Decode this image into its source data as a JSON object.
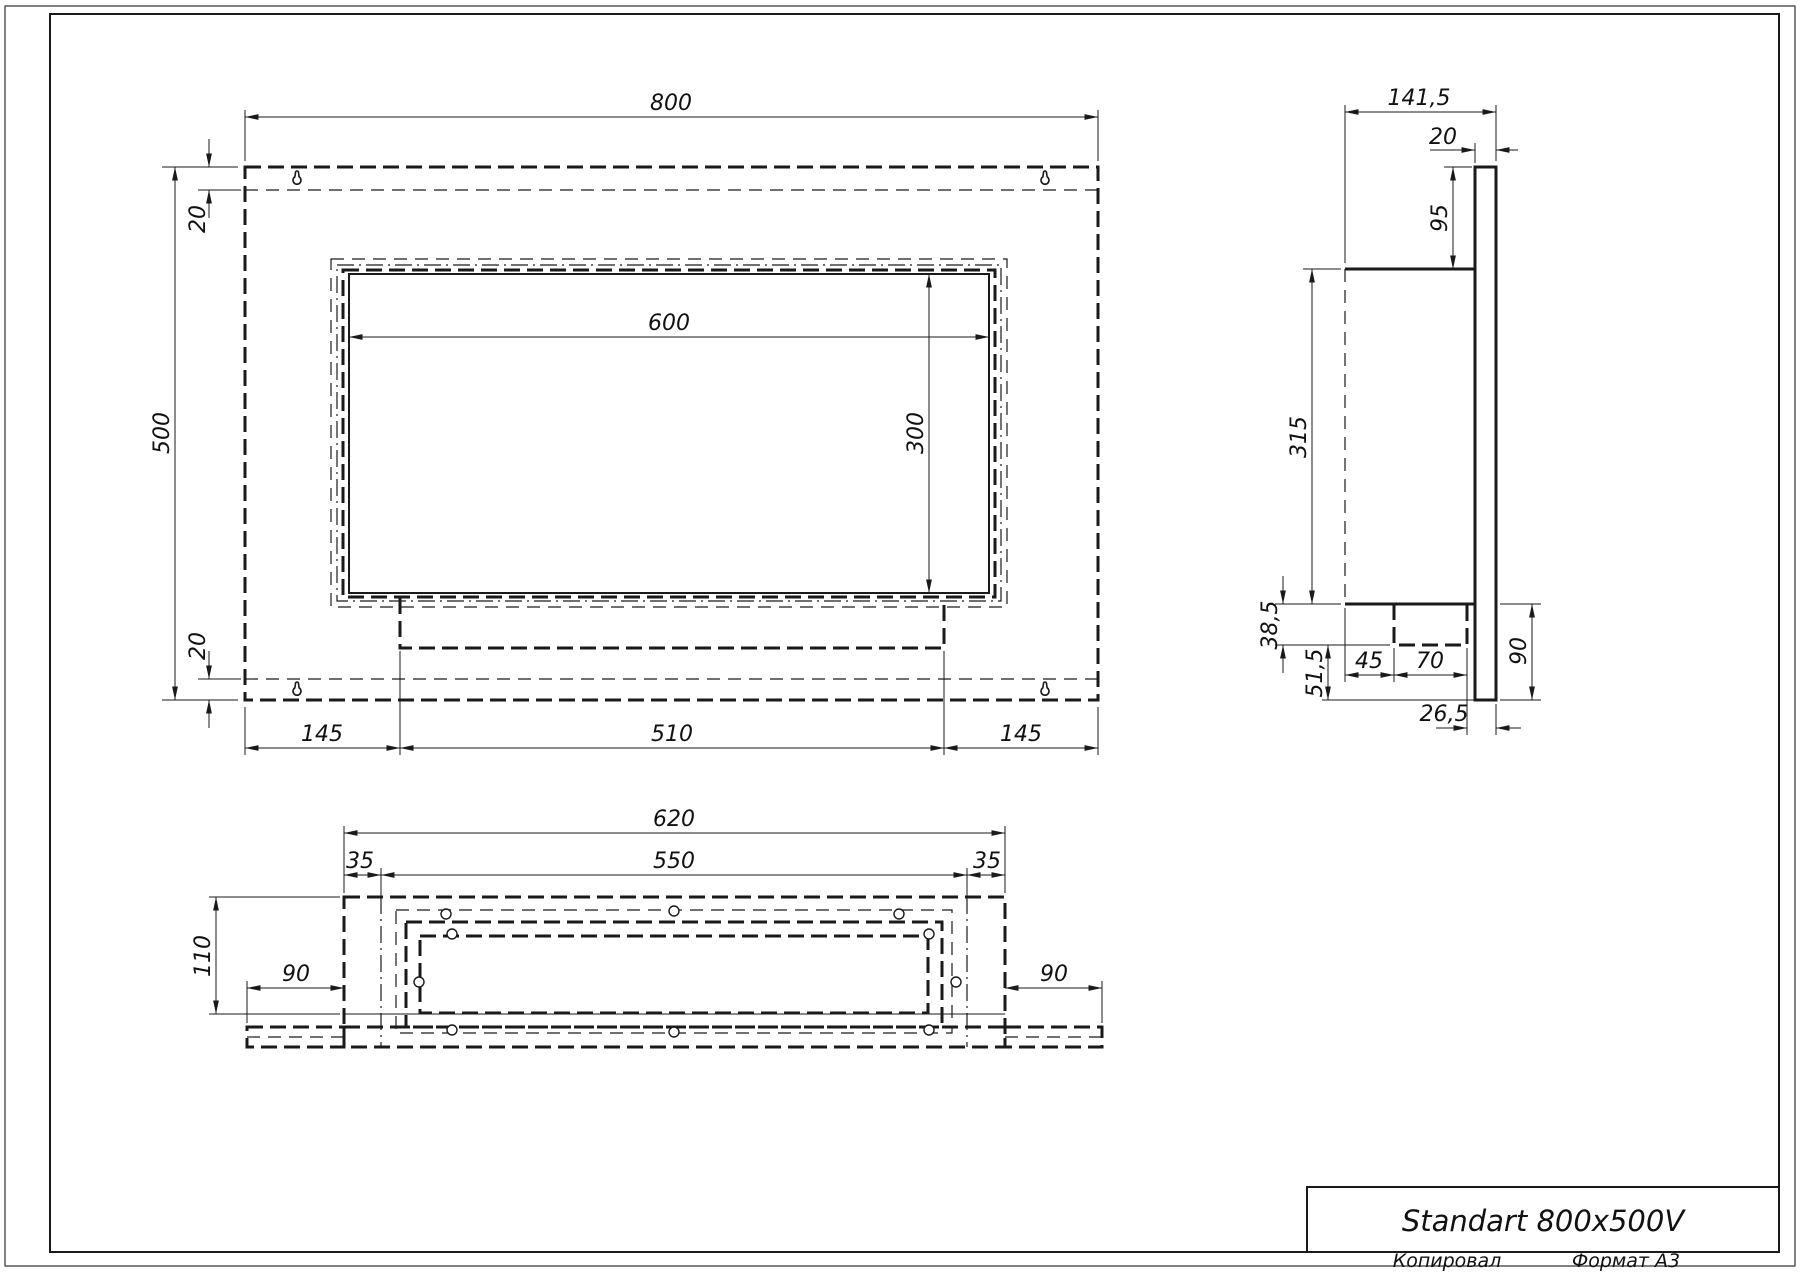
{
  "drawing": {
    "title": "Standart 800x500V",
    "stamp_copied": "Копировал",
    "stamp_format": "Формат A3"
  },
  "front_view": {
    "dims": {
      "width": "800",
      "height": "500",
      "flange_top": "20",
      "flange_bottom": "20",
      "opening_width": "600",
      "opening_height": "300",
      "left_offset": "145",
      "tray_width": "510",
      "right_offset": "145"
    }
  },
  "side_view": {
    "dims": {
      "depth": "141,5",
      "panel_thickness": "20",
      "top_offset": "95",
      "body_height": "315",
      "step_height": "38,5",
      "lower_height": "51,5",
      "front_inset": "45",
      "tray_depth": "70",
      "rear_inset": "26,5",
      "bracket_height": "90"
    }
  },
  "bottom_view": {
    "dims": {
      "outer_width": "620",
      "inner_width": "550",
      "margin_left": "35",
      "margin_right": "35",
      "depth": "110",
      "wing_left": "90",
      "wing_right": "90"
    }
  }
}
